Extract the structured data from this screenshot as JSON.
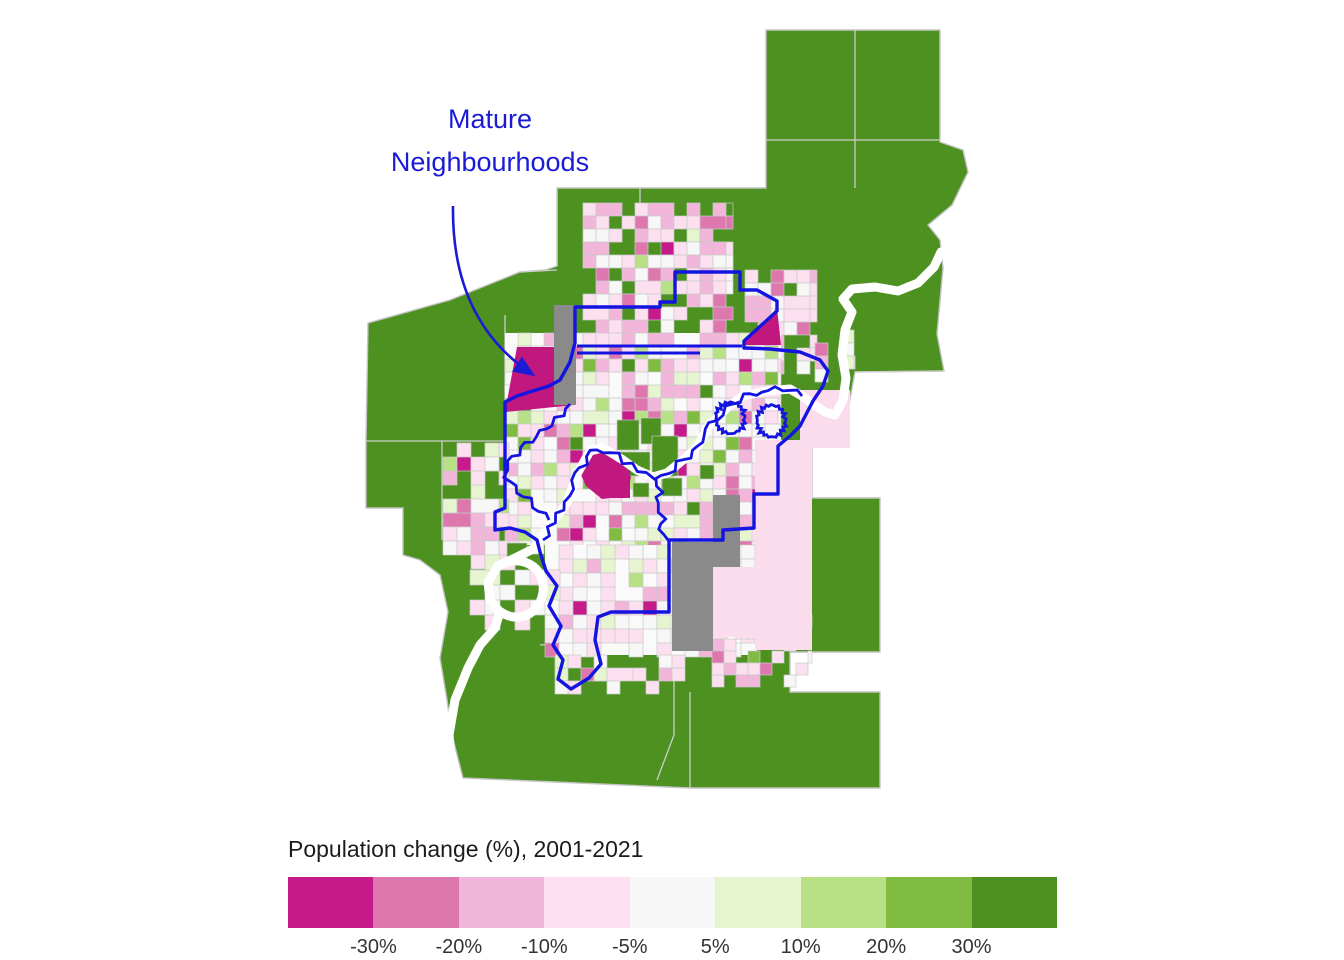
{
  "annotation": {
    "line1": "Mature",
    "line2": "Neighbourhoods",
    "color": "#1b1bd6"
  },
  "legend": {
    "title": "Population change (%), 2001-2021",
    "labels": [
      "-30%",
      "-20%",
      "-10%",
      "-5%",
      "5%",
      "10%",
      "20%",
      "30%"
    ],
    "colors": [
      "#c51b8a",
      "#de77ae",
      "#f1b6da",
      "#fde0ef",
      "#f7f7f7",
      "#e6f5d0",
      "#b8e186",
      "#7fbc41",
      "#4d9221"
    ],
    "title_color": "#1c1c1c",
    "label_color": "#333333"
  },
  "map": {
    "colors": {
      "rural_green": "#4d9221",
      "no_data_gray": "#8a8a8a",
      "river_white": "#ffffff",
      "boundary_blue": "#1414e0",
      "municipal_line": "#cdcdcd",
      "tract_line": "#c9c9c9",
      "decline_magenta": "#c0187e",
      "suburb_pink": "#fbdcec",
      "urban_base": "#fafafa"
    }
  }
}
